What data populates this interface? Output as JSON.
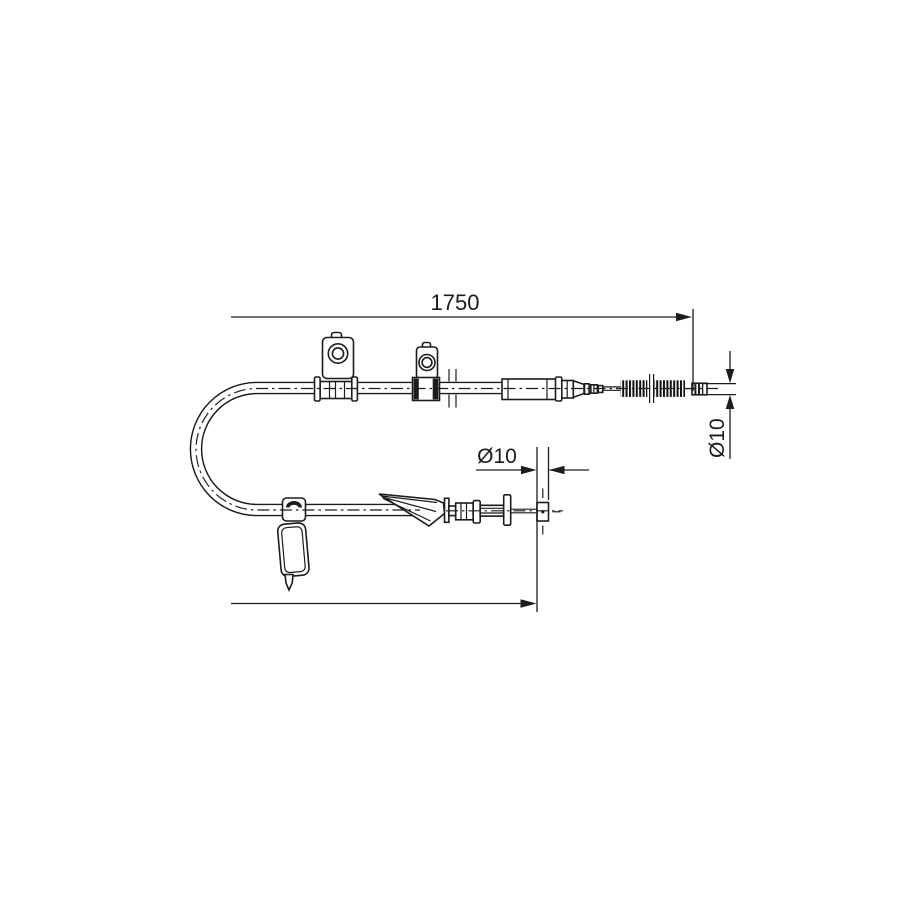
{
  "page": {
    "background_color": "#ffffff",
    "line_color": "#1c1c1c"
  },
  "drawing": {
    "type": "technical-line-drawing",
    "subject": "parking brake cable assembly",
    "dimensions": {
      "overall_length": {
        "value": "1750",
        "orientation": "horizontal-top"
      },
      "cable_end_diameter": {
        "value": "Ø10",
        "orientation": "vertical-right-rotated"
      },
      "rod_end_diameter": {
        "value": "Ø10",
        "orientation": "horizontal-middle"
      },
      "lower_length": {
        "value": "",
        "orientation": "horizontal-bottom-unlabeled"
      }
    }
  }
}
